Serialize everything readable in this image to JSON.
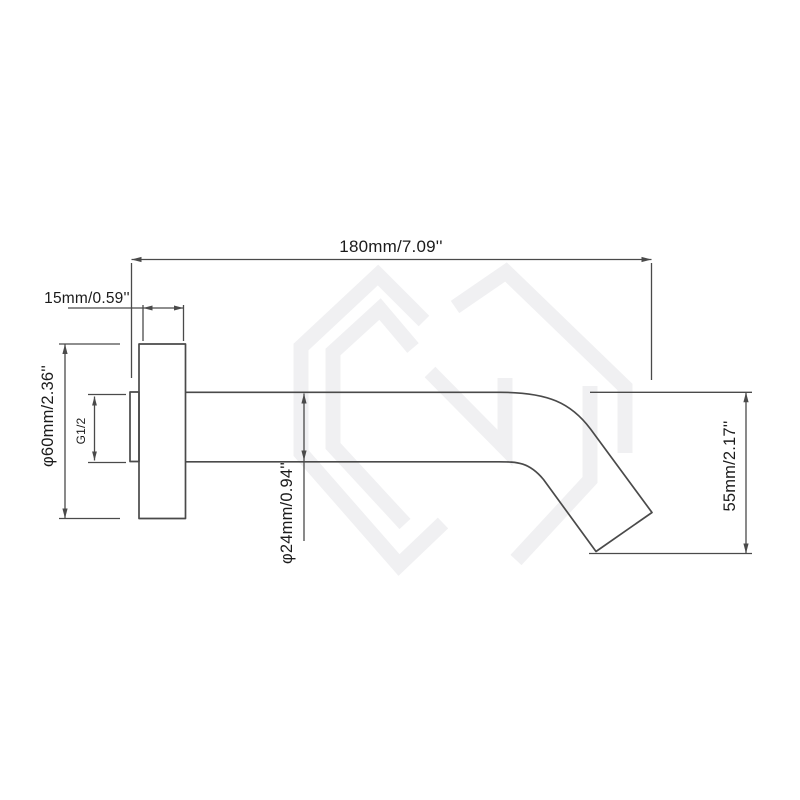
{
  "drawing": {
    "kind": "wall-mounted bathtub spout dimension drawing",
    "dimensions": {
      "overall_length": "180mm/7.09''",
      "flange_thickness": "15mm/0.59''",
      "flange_diameter": "φ60mm/2.36''",
      "thread_size": "G1/2",
      "spout_diameter": "φ24mm/0.94''",
      "spout_drop": "55mm/2.17''"
    },
    "colors": {
      "line": "#4a4a4a",
      "text": "#1b1b1b",
      "watermark": "#f0f0f2",
      "background": "#ffffff"
    },
    "watermark_icon": "hexagon-monogram-logo"
  }
}
